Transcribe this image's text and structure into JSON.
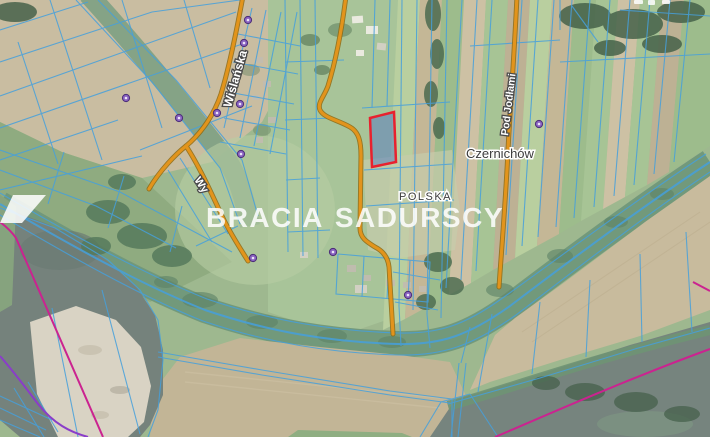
{
  "map": {
    "place_labels": [
      {
        "text": "Czernichów"
      },
      {
        "text": "POLSKA"
      }
    ],
    "street_labels": [
      {
        "text": "Wiślańska"
      },
      {
        "text": "Pod Jodłami"
      },
      {
        "text": "Wy"
      }
    ],
    "watermark": {
      "brand_left": "BRACIA",
      "brand_right": "SADURSCY"
    },
    "colors": {
      "highlight_parcel_outline": "#e8212e",
      "highlight_parcel_fill": "#5b7fc0",
      "cadastral_line_blue": "#46a0dc",
      "road_orange": "#e2941c",
      "road_edge_brown": "#8f6a12",
      "boundary_magenta": "#cb2390",
      "boundary_purple": "#8a3dc9",
      "poi_marker_purple": "#8a63c0",
      "river_water": "#76847e",
      "sandbar": "#d9d3c4",
      "watermark_white": "#ffffff"
    }
  }
}
